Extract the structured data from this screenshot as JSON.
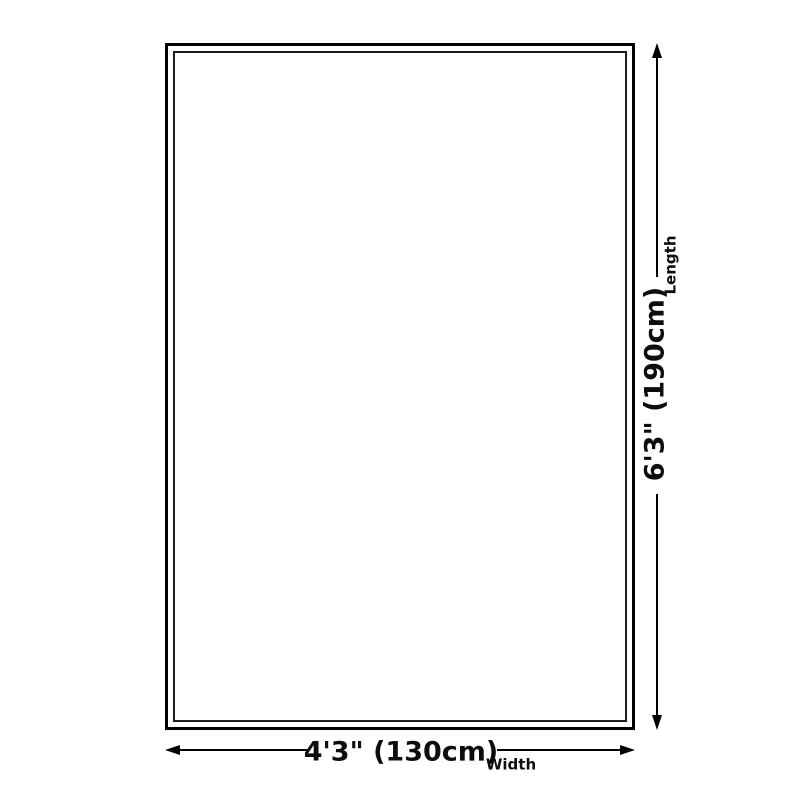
{
  "diagram": {
    "title": "rug-size-diagram",
    "length": {
      "value": "6'3\" (190cm)",
      "label": "Length"
    },
    "width": {
      "value": "4'3\" (130cm)",
      "label": "Width"
    }
  },
  "colors": {
    "background": "#ffffff",
    "outline": "#000000",
    "text": "#0d0d0d"
  }
}
